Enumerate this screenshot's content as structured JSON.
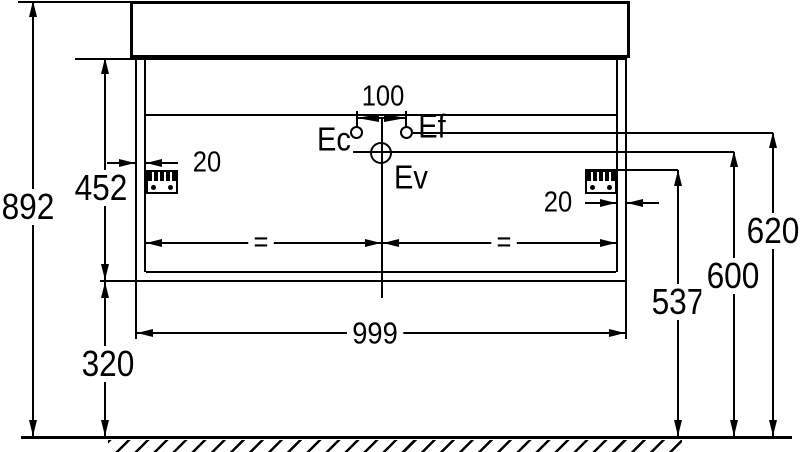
{
  "drawing": {
    "colors": {
      "line": "#000000",
      "background": "#ffffff"
    },
    "dimensions": {
      "overall_height": "892",
      "cabinet_height": "452",
      "ground_clearance": "320",
      "width": "999",
      "wall_thickness_left": "20",
      "wall_thickness_right": "20",
      "tap_hole_spacing": "100",
      "bracket_height": "537",
      "drain_height": "600",
      "supply_height": "620",
      "equal_left": "=",
      "equal_right": "="
    },
    "labels": {
      "hot_water": "Ec",
      "cold_water": "Ef",
      "drain": "Ev"
    }
  }
}
